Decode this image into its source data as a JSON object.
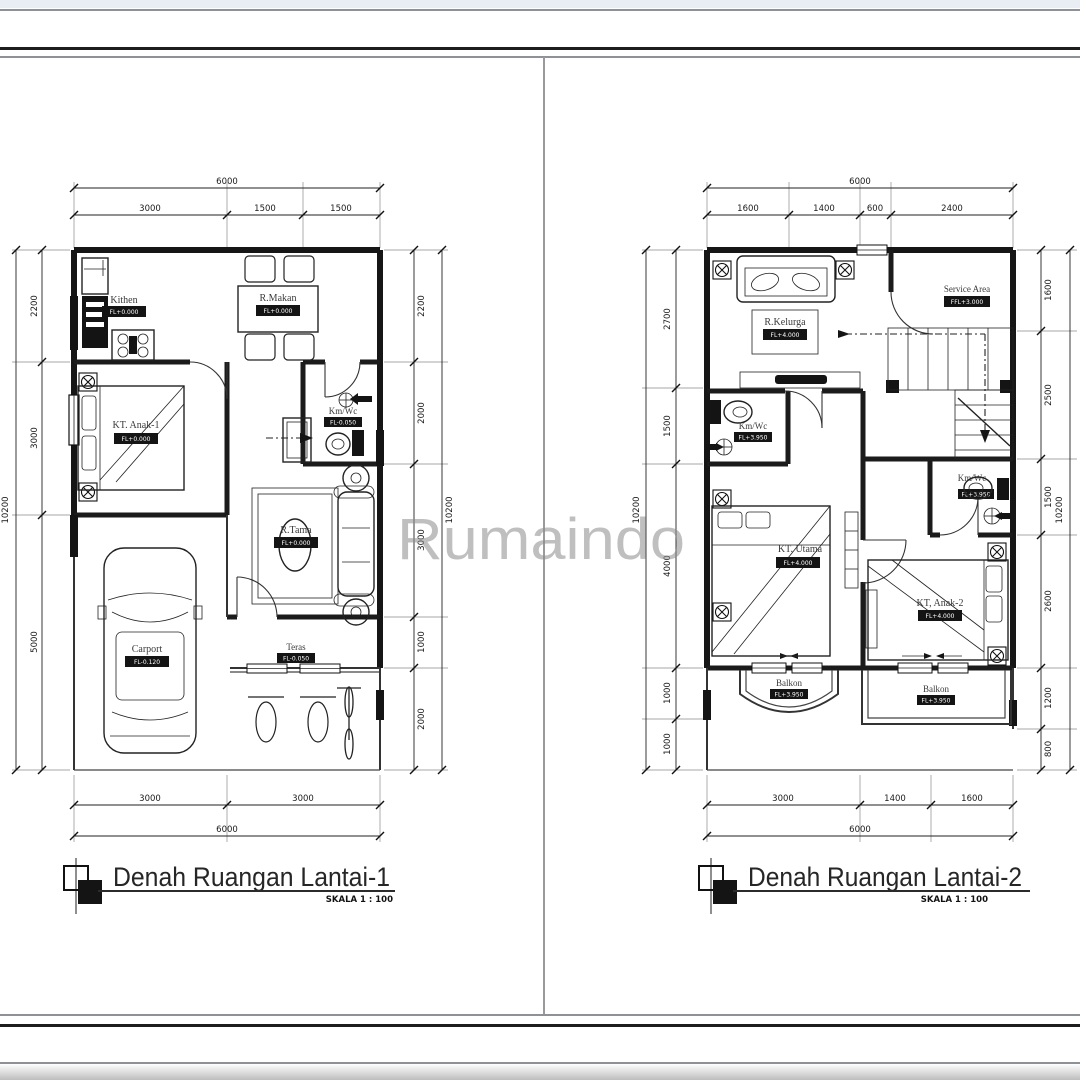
{
  "page": {
    "watermark": "Rumaindo"
  },
  "plan1": {
    "title": "Denah Ruangan Lantai-1",
    "scale": "SKALA 1 : 100",
    "dim_top_total": "6000",
    "dim_top": [
      "3000",
      "1500",
      "1500"
    ],
    "dim_bottom": [
      "3000",
      "3000"
    ],
    "dim_bottom_total": "6000",
    "dim_left": [
      "2200",
      "3000",
      "5000"
    ],
    "dim_left_total": "10200",
    "dim_right": [
      "2200",
      "2000",
      "3000",
      "1000",
      "2000"
    ],
    "dim_right_total": "10200",
    "rooms": {
      "kitchen": {
        "name": "Kithen",
        "level": "FL+0.000"
      },
      "dining": {
        "name": "R.Makan",
        "level": "FL+0.000"
      },
      "bed1": {
        "name": "KT. Anak-1",
        "level": "FL+0.000"
      },
      "bath": {
        "name": "Km/Wc",
        "level": "FL-0.050"
      },
      "living": {
        "name": "R.Tama",
        "level": "FL+0.000"
      },
      "carport": {
        "name": "Carport",
        "level": "FL-0.120"
      },
      "terrace": {
        "name": "Teras",
        "level": "FL-0.050"
      }
    }
  },
  "plan2": {
    "title": "Denah Ruangan Lantai-2",
    "scale": "SKALA 1 : 100",
    "dim_top_total": "6000",
    "dim_top": [
      "1600",
      "1400",
      "600",
      "2400"
    ],
    "dim_bottom": [
      "3000",
      "1400",
      "1600"
    ],
    "dim_bottom_total": "6000",
    "dim_left": [
      "2700",
      "1500",
      "4000",
      "1000",
      "1000"
    ],
    "dim_left_total": "10200",
    "dim_right": [
      "1600",
      "2500",
      "1500",
      "2600",
      "1200",
      "800"
    ],
    "dim_right_total": "10200",
    "rooms": {
      "family": {
        "name": "R.Kelurga",
        "level": "FL+4.000"
      },
      "service": {
        "name": "Service Area",
        "level": "FFL+3.000"
      },
      "bath_left": {
        "name": "Km/Wc",
        "level": "FL+3.950"
      },
      "master": {
        "name": "KT. Utama",
        "level": "FL+4.000"
      },
      "bath_right": {
        "name": "Km/Wc",
        "level": "FL+3.950"
      },
      "bed2": {
        "name": "KT, Anak-2",
        "level": "FL+4.000"
      },
      "balcony_left": {
        "name": "Balkon",
        "level": "FL+3.950"
      },
      "balcony_right": {
        "name": "Balkon",
        "level": "FL+3.950"
      }
    }
  }
}
